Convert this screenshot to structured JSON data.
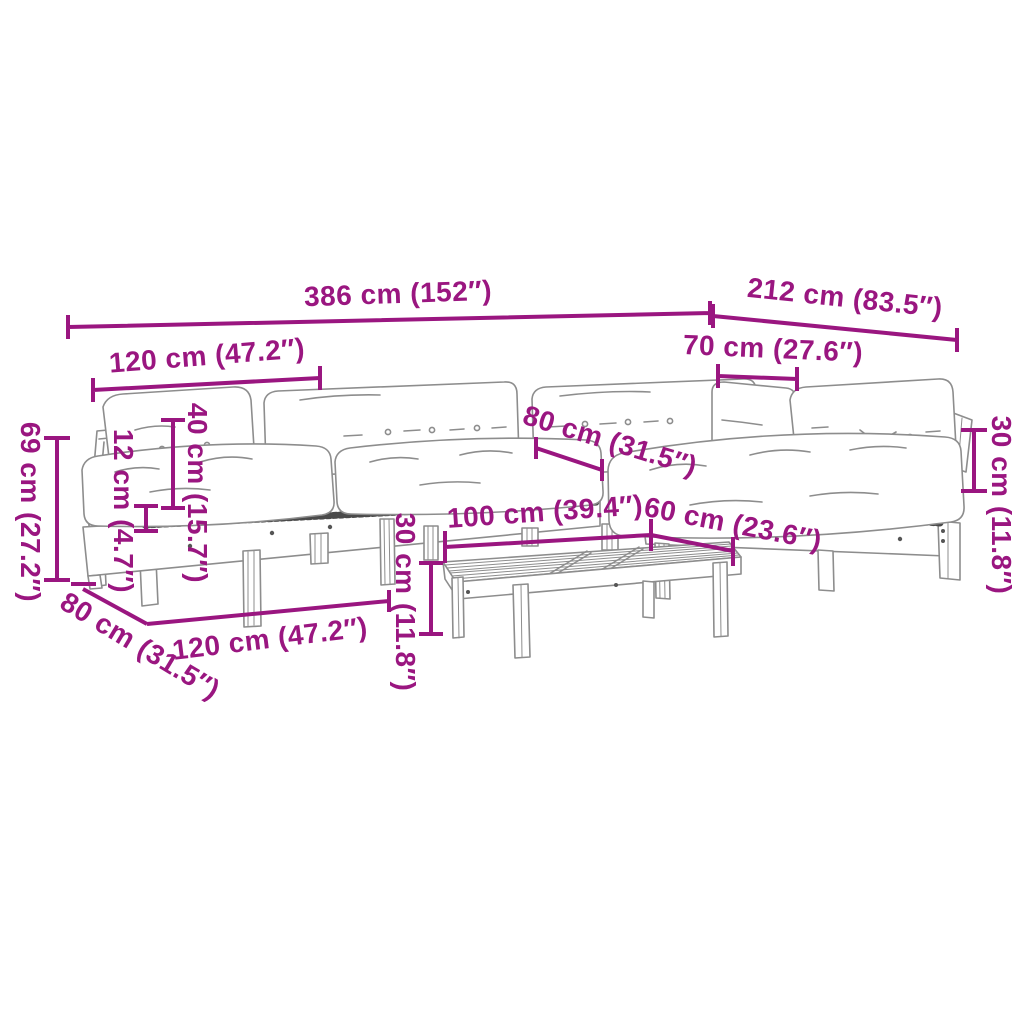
{
  "figure": {
    "type": "product-dimension-diagram",
    "subject": "pallet garden lounge set with cushions and coffee table",
    "background_color": "#ffffff",
    "accent_color": "#9A1680",
    "line_art_color": "#8d8d8d"
  },
  "dimensions": [
    {
      "id": "overall-width",
      "label": "386 cm (152″)"
    },
    {
      "id": "overall-depth",
      "label": "212 cm (83.5″)"
    },
    {
      "id": "module-width-top",
      "label": "120 cm (47.2″)"
    },
    {
      "id": "corner-seat-width",
      "label": "70 cm (27.6″)"
    },
    {
      "id": "backrest-height",
      "label": "40 cm (15.7″)"
    },
    {
      "id": "seat-cushion-thickness",
      "label": "12 cm (4.7″)"
    },
    {
      "id": "overall-height",
      "label": "69 cm (27.2″)"
    },
    {
      "id": "right-backrest-height",
      "label": "30 cm (11.8″)"
    },
    {
      "id": "seat-depth",
      "label": "80 cm (31.5″)"
    },
    {
      "id": "table-length",
      "label": "100 cm (39.4″)"
    },
    {
      "id": "table-width",
      "label": "60 cm (23.6″)"
    },
    {
      "id": "table-height",
      "label": "30 cm (11.8″)"
    },
    {
      "id": "module-depth-bottom",
      "label": "80 cm (31.5″)"
    },
    {
      "id": "module-width-bottom",
      "label": "120 cm (47.2″)"
    }
  ]
}
